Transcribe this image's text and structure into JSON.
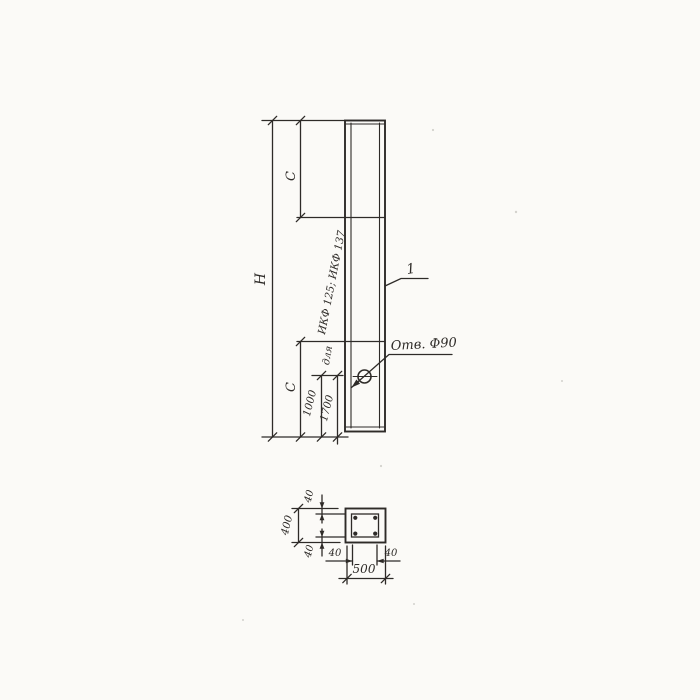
{
  "meta": {
    "drawing_type": "reinforced-column technical drawing, elevation and cross-section",
    "background": "#fbfaf7",
    "line_color": "#2e2b28"
  },
  "elevation": {
    "dim_overall_height": "H",
    "dim_segment_top": "C",
    "dim_segment_bottom": "C",
    "dim_hole_variant_1": "1000",
    "dim_hole_variant_2": "1700",
    "note_line_1": "для",
    "note_line_2": "ИКФ 125; ИКФ 137",
    "hole_callout": "Отв. Ф90",
    "item_mark": "1"
  },
  "section": {
    "dim_width": "500",
    "dim_height": "400",
    "dim_wall_top": "40",
    "dim_wall_bottom": "40",
    "dim_wall_left": "40",
    "dim_wall_right": "40"
  }
}
